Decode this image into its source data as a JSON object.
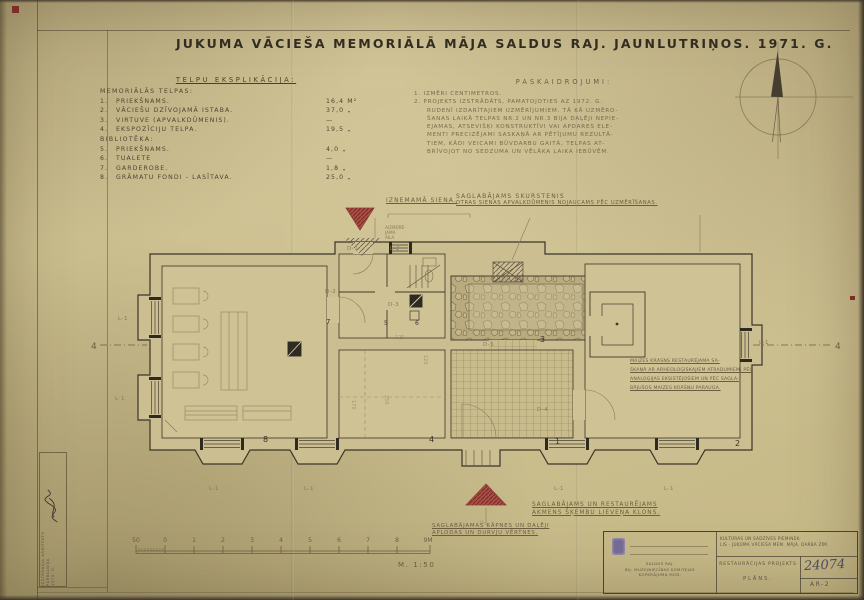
{
  "sheet": {
    "title": "JUKUMA VĀCIEŠA MEMORIĀLĀ MĀJA SALDUS RAJ. JAUNLUTRIŅOS. 1971. G."
  },
  "legend": {
    "heading": "TELPU EKSPLIKĀCIJA:",
    "group1": "MEMORIĀLĀS TELPAS:",
    "rows1": [
      {
        "num": "1.",
        "name": "PRIEKŠNAMS.",
        "area": "16,4 M²"
      },
      {
        "num": "2.",
        "name": "VĀCIEŠU DZĪVOJAMĀ ISTABA.",
        "area": "37,0 „"
      },
      {
        "num": "3.",
        "name": "VIRTUVE (APVALKDŪMENIS).",
        "area": "—"
      },
      {
        "num": "4.",
        "name": "EKSPOZĪCIJU TELPA.",
        "area": "19,5 „"
      }
    ],
    "group2": "BIBLIOTĒKA:",
    "rows2": [
      {
        "num": "5.",
        "name": "PRIEKŠNAMS.",
        "area": "4,0 „"
      },
      {
        "num": "6.",
        "name": "TUALETE",
        "area": "—"
      },
      {
        "num": "7.",
        "name": "GARDEROBE.",
        "area": "1,8 „"
      },
      {
        "num": "8.",
        "name": "GRĀMATU FONDI - LASĪTAVA.",
        "area": "25,0 „"
      }
    ]
  },
  "notes": {
    "heading": "PASKAIDROJUMI:",
    "item1": "1. IZMĒRI CENTIMETROS.",
    "item2": [
      "2. PROJEKTS IZSTRĀDĀTS, PAMATOJOTIES AZ 1972. G.",
      "RUDENĪ IZDARĪTAJIEM UZMĒRĪJUMIEM. TĀ KĀ UZMĒRO-",
      "ŠANAS LAIKĀ TELPAS NR.2 UN NR.3 BIJA DAĻĒJI NEPIE-",
      "EJAMAS, ATSEVIŠĶI KONSTRUKTĪVI VAI APDARES ELE-",
      "MENTI PRECIZĒJAMI SASKAŅĀ AR PĒTĪJUMU REZULTĀ-",
      "TIEM, KĀDI VEICAMI BŪVDARBU GAITĀ, TELPAS AT-",
      "BRĪVOJOT NO SEDZUMA UN VĒLĀKA LAIKA IEBŪVĒM."
    ]
  },
  "annotations": {
    "removable_wall": "IZŅEMAMĀ SIENA.",
    "chimney1": "SAGLABĀJAMS SKURSTENIS",
    "chimney2": "OTRAS SIENAS APVALKDŪMENIS NOJAUCAMS PĒC UZMĒRĪŠANAS.",
    "oven": [
      "MAIZES KRĀSNS RESTAURĒJAMA SA-",
      "SKAŅĀ AR ARHEOLOĢISKAJIEM ATRADUMIEM, PĒC",
      "ANALOĢIJAS EKSISTĒJOŠIEM UN PĒC SAGLA-",
      "BĀJUŠOS MAIZES KRĀŠŅU PARAUGA."
    ],
    "porch": [
      "SAGLABĀJAMS UN RESTAURĒJAMS",
      "AKMENS ŠĶEMBU LIEVEŅA KLONS."
    ],
    "stairs": [
      "SAGLABĀJAMAS KĀPNES UN DAĻĒJI",
      "APLODAS UN DURVJU VĒRTNES."
    ],
    "walled_niche": [
      "AIZMŪRĒ-",
      "JAMA",
      "AILA"
    ]
  },
  "plan": {
    "rooms": {
      "r1": "1",
      "r2": "2",
      "r3": "3",
      "r4": "4",
      "r5": "5",
      "r6": "6",
      "r7": "7",
      "r8": "8"
    },
    "window_label": "L-1",
    "window2_label": "L-2",
    "doors": {
      "d1": "D-1",
      "d2": "D-2",
      "d3": "D-3",
      "d4": "D-4",
      "d5": "D-5"
    },
    "section": "4",
    "dims": {
      "a": "125",
      "b": "120",
      "c": "250",
      "d": "170",
      "e": "1b"
    }
  },
  "scalebar": {
    "ticks": [
      "50",
      "0",
      "1",
      "2",
      "3",
      "4",
      "5",
      "6",
      "7",
      "8",
      "9M"
    ],
    "scale": "M. 1:50"
  },
  "titleblock": {
    "header1": "KULTŪRAS UN SADZĪVES PIEMINEK-",
    "header2": "LIS - JUKUMA VĀCIEŠA MEM. MĀJA. DARBA ZĪM.",
    "org": [
      "SALDUS RAJ.",
      "BIJ. MUZEJNIECĪBAS KOMITEJAS",
      "KOPKRĀJUMA MOD."
    ],
    "project": "RESTAURĀCIJAS PROJEKTS",
    "sheet": "PLĀNS.",
    "number": "24074",
    "code": "AR-2"
  },
  "stamp": {
    "lines": [
      "IZSTRĀDĀJA  ARHITEKTS",
      "PĀRBAUDĪJA",
      "1973. G."
    ]
  }
}
